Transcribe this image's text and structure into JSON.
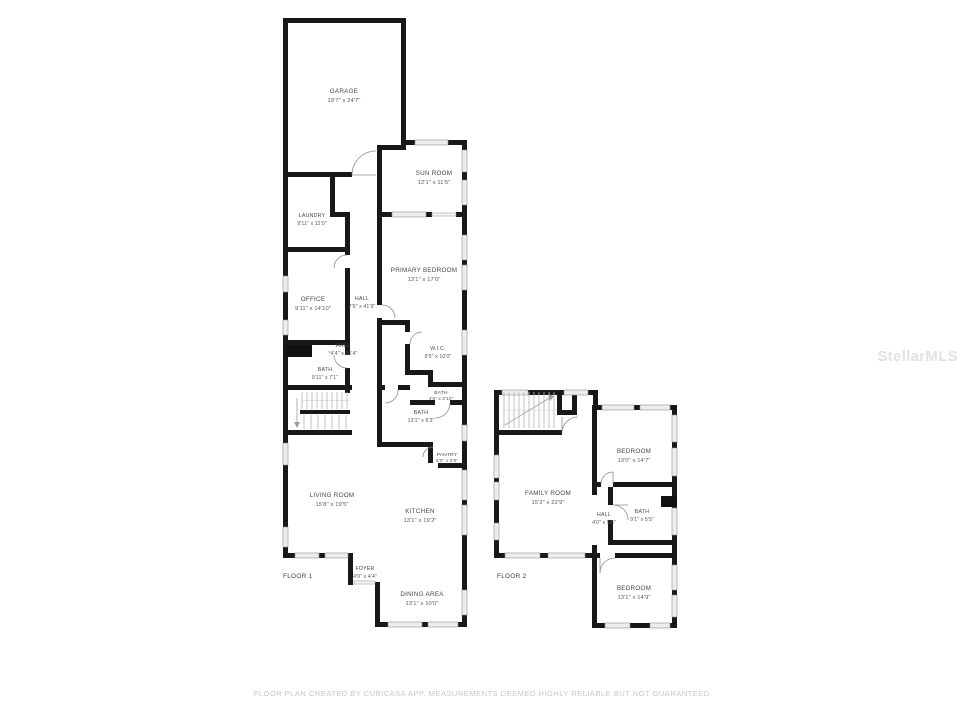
{
  "watermark": {
    "label": "StellarMLS"
  },
  "footer": {
    "text": "FLOOR PLAN CREATED BY CUBICASA APP. MEASUREMENTS DEEMED HIGHLY RELIABLE BUT NOT GUARANTEED."
  },
  "colors": {
    "background": "#ffffff",
    "wall": "#181818",
    "window_fill": "#ededed",
    "window_stroke": "#8f8f8f",
    "room_text": "#474747",
    "footer_text": "#c7c7c7",
    "watermark_text": "#e2e2e2"
  },
  "floor1": {
    "label": "FLOOR 1",
    "rooms": [
      {
        "name": "GARAGE",
        "dims": "19'7\" x 24'7\""
      },
      {
        "name": "SUN ROOM",
        "dims": "12'1\" x 11'5\""
      },
      {
        "name": "LAUNDRY",
        "dims": "9'11\" x 12'0\""
      },
      {
        "name": "OFFICE",
        "dims": "9'11\" x 14'10\""
      },
      {
        "name": "HALL",
        "dims": "7'6\" x 41'9\""
      },
      {
        "name": "PRIMARY BEDROOM",
        "dims": "13'1\" x 17'0\""
      },
      {
        "name": "HALL",
        "dims": "*4'4\" x 10'4\""
      },
      {
        "name": "W.I.C.",
        "dims": "8'5\" x 10'0\""
      },
      {
        "name": "BATH",
        "dims": "9'11\" x 7'1\""
      },
      {
        "name": "BATH",
        "dims": "4'9\" x 2'10\""
      },
      {
        "name": "BATH",
        "dims": "13'1\" x 9'3\""
      },
      {
        "name": "PANTRY",
        "dims": "5'0\" x 3'8\""
      },
      {
        "name": "LIVING ROOM",
        "dims": "15'8\" x 19'5\""
      },
      {
        "name": "KITCHEN",
        "dims": "13'1\" x 19'2\""
      },
      {
        "name": "FOYER",
        "dims": "4'9\" x 4'4\""
      },
      {
        "name": "DINING AREA",
        "dims": "13'1\" x 10'0\""
      }
    ]
  },
  "floor2": {
    "label": "FLOOR 2",
    "rooms": [
      {
        "name": "FAMILY ROOM",
        "dims": "15'3\" x 22'9\""
      },
      {
        "name": "BEDROOM",
        "dims": "13'0\" x 14'7\""
      },
      {
        "name": "HALL",
        "dims": "4'0\" x 5'5\""
      },
      {
        "name": "BATH",
        "dims": "9'1\" x 5'5\""
      },
      {
        "name": "BEDROOM",
        "dims": "13'1\" x 14'9\""
      }
    ]
  }
}
